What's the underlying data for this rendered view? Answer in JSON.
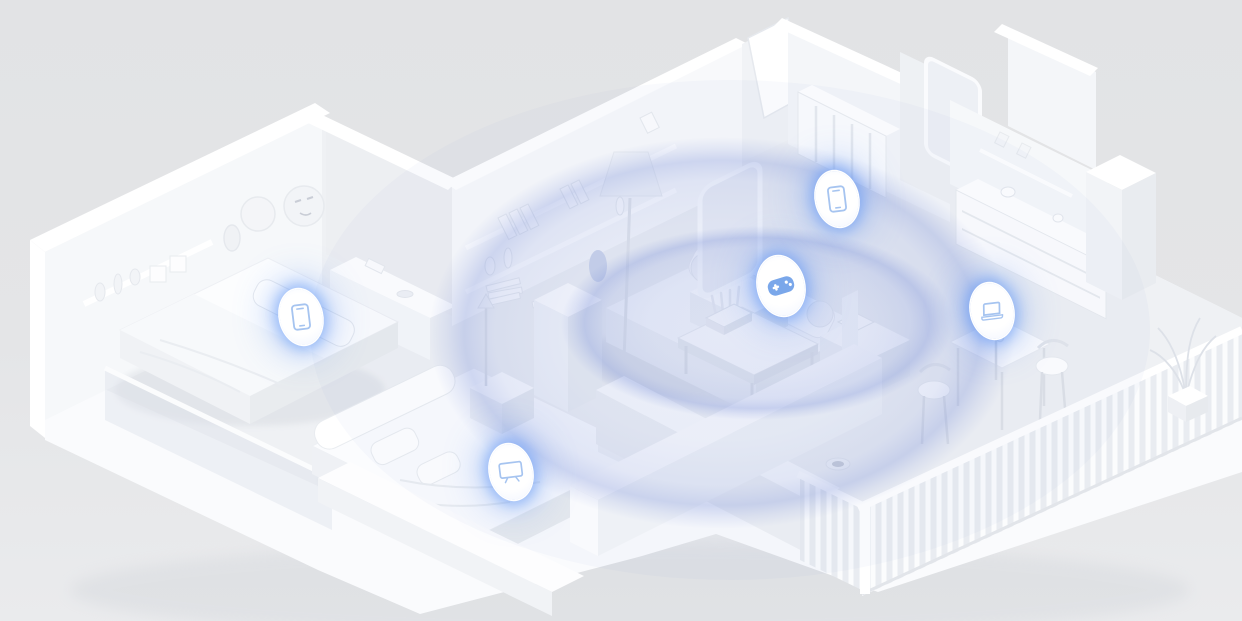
{
  "meta": {
    "title": "smart-home-wifi-coverage-render",
    "description": "Isometric cutaway 3D render of an all-white apartment showing Wi-Fi coverage ripples from a router and connected device icons",
    "width": 1242,
    "height": 621
  },
  "colors": {
    "background": "#e3e4e6",
    "floor": "#eff1f4",
    "wall_lit": "#f8f9fb",
    "wall_shade": "#eceef1",
    "wall_top": "#ffffff",
    "soft_shadow": "#c9cdd5",
    "accent_blue": "#4f8ef7",
    "glow_blue": "rgba(90,145,246,0.55)",
    "ripple_blue": "#7e93da",
    "icon_stroke": "#a6c4f0",
    "gamepad_fill": "#6f9fe8",
    "badge_bg": "#ffffff"
  },
  "scene": {
    "router": {
      "name": "wifi-router",
      "location": "coffee-table-living-room",
      "x": 728,
      "y": 312
    },
    "ripples": [
      {
        "cx": 722,
        "cy": 333,
        "rx": 293,
        "ry": 196,
        "opacity": 0.95
      },
      {
        "cx": 757,
        "cy": 323,
        "rx": 196,
        "ry": 97,
        "opacity": 1.0
      }
    ],
    "devices": [
      {
        "icon": "phone-icon",
        "room": "bedroom-left",
        "x": 301,
        "y": 317,
        "w": 42,
        "h": 56
      },
      {
        "icon": "phone-icon",
        "room": "hallway",
        "x": 837,
        "y": 199,
        "w": 42,
        "h": 56
      },
      {
        "icon": "gamepad-icon",
        "room": "living-room",
        "x": 781,
        "y": 286,
        "w": 46,
        "h": 60
      },
      {
        "icon": "laptop-icon",
        "room": "dining-nook",
        "x": 992,
        "y": 311,
        "w": 42,
        "h": 56
      },
      {
        "icon": "tv-icon",
        "room": "bedroom-front",
        "x": 511,
        "y": 472,
        "w": 42,
        "h": 56
      }
    ]
  }
}
